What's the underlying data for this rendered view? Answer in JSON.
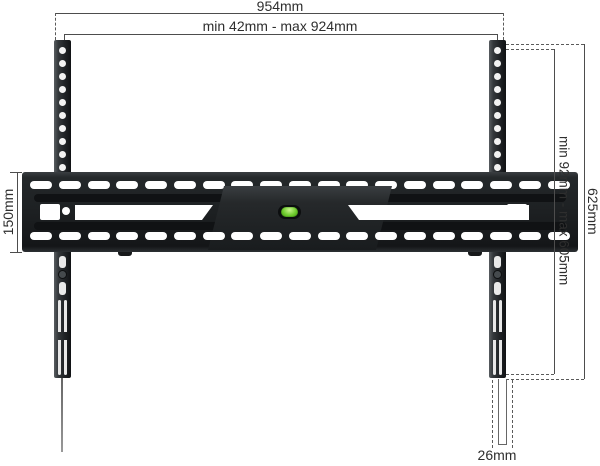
{
  "diagram": {
    "type": "tv-wall-mount-dimension-diagram",
    "dimensions": {
      "top_outer": "954mm",
      "top_range": "min 42mm - max 924mm",
      "left_height": "150mm",
      "right_range": "min 92mm - max 605mm",
      "right_outer": "625mm",
      "bottom_rail_width": "26mm"
    },
    "colors": {
      "background": "#ffffff",
      "metal_dark": "#1d2022",
      "metal_mid": "#2c3033",
      "metal_light": "#4a4f52",
      "dim_line": "#4d4d4d",
      "label_text": "#2e2e2e",
      "level_green": "#6ecb2d",
      "level_green_light": "#c9f58e",
      "cutout": "#ffffff"
    }
  }
}
